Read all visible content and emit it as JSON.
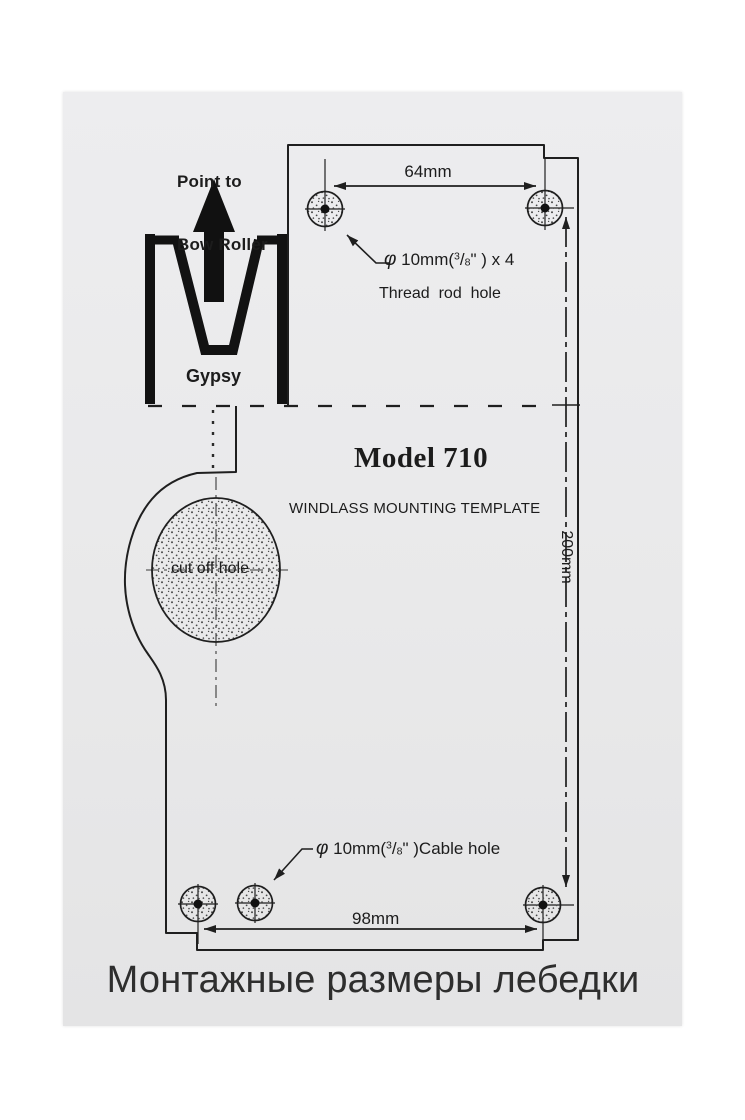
{
  "photo": {
    "background_color": "#ffffff",
    "paper_color": "#e9e9ea",
    "ink_color": "#1f1f1f"
  },
  "header": {
    "point_to_line1": "Point to",
    "point_to_line2": "Bow Roller",
    "gypsy_label": "Gypsy"
  },
  "title": {
    "model": "Model 710",
    "subtitle": "WINDLASS MOUNTING TEMPLATE"
  },
  "dimensions": {
    "top_hole_spacing": "64mm",
    "bottom_hole_spacing": "98mm",
    "vertical_length": "200mm"
  },
  "hole_notes": {
    "thread": {
      "phi": "φ",
      "prefix": " 10mm(",
      "frac_num": "3",
      "frac_slash": "/",
      "frac_den": "8",
      "suffix": "\" ) x 4",
      "caption": "Thread  rod  hole"
    },
    "cable": {
      "phi": "φ",
      "prefix": " 10mm(",
      "frac_num": "3",
      "frac_slash": "/",
      "frac_den": "8",
      "suffix": "\" )Cable hole"
    },
    "cut_off": "cut off hole"
  },
  "footer": {
    "caption": "Монтажные размеры лебедки"
  }
}
